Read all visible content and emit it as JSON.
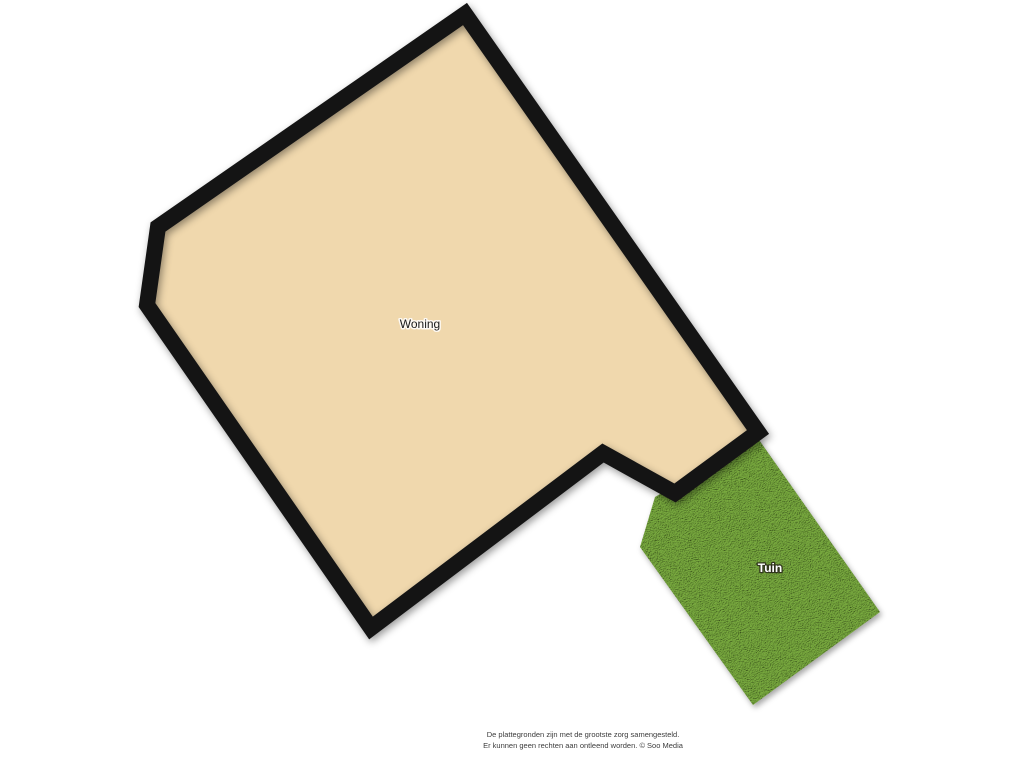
{
  "floorplan": {
    "labels": {
      "building": "Woning",
      "garden": "Tuin"
    },
    "colors": {
      "floor_fill": "#f0d8ad",
      "wall": "#141414",
      "garden_base": "#669834",
      "background": "#ffffff",
      "building_label_color": "#1a1a1a"
    },
    "shapes": {
      "building_outline_points": "465,14 758,432 675,493 603,453 371,628 147,305 158,227",
      "garden_outline_points": "655,497 757,437 880,612 753,705 640,547"
    }
  },
  "footer": {
    "line1": "De plattegronden zijn met de grootste zorg samengesteld.",
    "line2": "Er kunnen geen rechten aan ontleend worden. © Soo Media"
  }
}
